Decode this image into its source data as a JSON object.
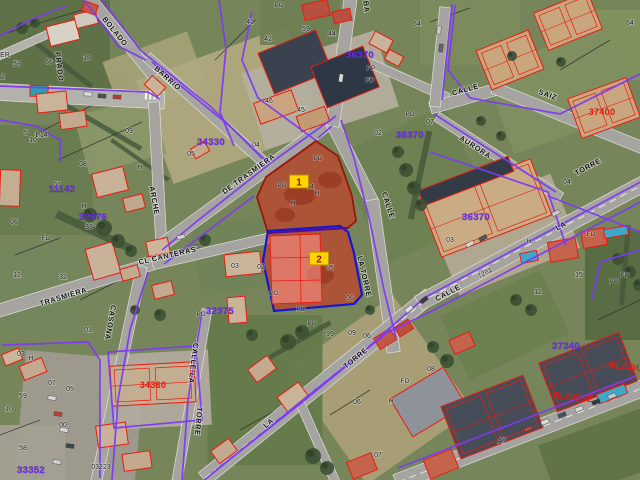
{
  "app": {
    "title": "Cadastral aerial map with highlighted parcels"
  },
  "map": {
    "type": "cadastral-aerial-map",
    "highlighted_parcels": [
      {
        "marker": "1",
        "parcel_number": "04",
        "x": 299,
        "y": 182
      },
      {
        "marker": "2",
        "parcel_number": "05",
        "x": 319,
        "y": 259
      }
    ],
    "colors": {
      "parcel_highlight_fill": "rgba(221,38,24,0.52)",
      "parcel1_border": "#9a1608",
      "parcel2_border": "#1717cf",
      "parcel_divider": "#4a0f9e",
      "parcel_building_fill": "rgba(255,145,135,0.6)",
      "marker_fill": "#ffd400",
      "marker_border": "#b89000",
      "marker_text": "#8f1410",
      "boundary_purple": "#7c3bf2",
      "building_outline_red": "#ea1c10",
      "zone_text_purple": "#6d2cf0",
      "building_text_red": "#e31b12",
      "street_text": "#161616",
      "number_text": "#1b1b1b",
      "road_fill": "#a5a4a0",
      "pool_blue": "#3fa8c8"
    },
    "street_labels": [
      {
        "text": "BOLADO",
        "x": 113,
        "y": 33,
        "rot": 51
      },
      {
        "text": "BARRIO",
        "x": 166,
        "y": 80,
        "rot": 42
      },
      {
        "text": "PRADO",
        "x": 57,
        "y": 67,
        "rot": 83
      },
      {
        "text": "DE TRASMIERA",
        "x": 250,
        "y": 176,
        "rot": -36
      },
      {
        "text": "ARCHE",
        "x": 152,
        "y": 201,
        "rot": 80
      },
      {
        "text": "CL CANTERAS",
        "x": 168,
        "y": 258,
        "rot": -13
      },
      {
        "text": "TRASMIERA",
        "x": 64,
        "y": 299,
        "rot": -17
      },
      {
        "text": "CASONA",
        "x": 108,
        "y": 322,
        "rot": 100
      },
      {
        "text": "CALLE",
        "x": 386,
        "y": 206,
        "rot": 72
      },
      {
        "text": "LA TORRE",
        "x": 362,
        "y": 277,
        "rot": 77
      },
      {
        "text": "CALLE",
        "x": 466,
        "y": 92,
        "rot": -16
      },
      {
        "text": "SAIZ",
        "x": 547,
        "y": 97,
        "rot": 20
      },
      {
        "text": "AURORA",
        "x": 474,
        "y": 149,
        "rot": 33
      },
      {
        "text": "TORRE",
        "x": 589,
        "y": 169,
        "rot": -28
      },
      {
        "text": "LA",
        "x": 562,
        "y": 228,
        "rot": -28
      },
      {
        "text": "CALLE",
        "x": 449,
        "y": 295,
        "rot": -28
      },
      {
        "text": "TORRE",
        "x": 357,
        "y": 360,
        "rot": -39
      },
      {
        "text": "LA",
        "x": 270,
        "y": 425,
        "rot": -39
      },
      {
        "text": "CALLE LA",
        "x": 191,
        "y": 363,
        "rot": 97
      },
      {
        "text": "TORRE",
        "x": 196,
        "y": 421,
        "rot": 95
      },
      {
        "text": "BA",
        "x": 364,
        "y": 7,
        "rot": 83
      }
    ],
    "zone_labels": [
      {
        "text": "36370",
        "x": 360,
        "y": 58
      },
      {
        "text": "36370",
        "x": 410,
        "y": 138
      },
      {
        "text": "36370",
        "x": 476,
        "y": 220
      },
      {
        "text": "11142",
        "x": 62,
        "y": 192
      },
      {
        "text": "32376",
        "x": 93,
        "y": 220
      },
      {
        "text": "32375",
        "x": 220,
        "y": 314
      },
      {
        "text": "34330",
        "x": 211,
        "y": 145
      },
      {
        "text": "33352",
        "x": 31,
        "y": 473
      },
      {
        "text": "37340",
        "x": 566,
        "y": 349
      }
    ],
    "building_labels": [
      {
        "text": "37400",
        "x": 602,
        "y": 115,
        "rot": 0
      },
      {
        "text": "34360",
        "x": 153,
        "y": 388,
        "rot": 0
      },
      {
        "text": "BLOQUE",
        "x": 573,
        "y": 400,
        "rot": 6
      },
      {
        "text": "BLOQUE",
        "x": 629,
        "y": 370,
        "rot": 6
      }
    ],
    "parcel_numbers": [
      {
        "text": "ER",
        "x": 5,
        "y": 57
      },
      {
        "text": "53",
        "x": 17,
        "y": 66
      },
      {
        "text": "66",
        "x": 49,
        "y": 64
      },
      {
        "text": "18",
        "x": 87,
        "y": 60
      },
      {
        "text": "2",
        "x": 3,
        "y": 79
      },
      {
        "text": "5",
        "x": 26,
        "y": 135
      },
      {
        "text": "1.14",
        "x": 41,
        "y": 137
      },
      {
        "text": "10",
        "x": 33,
        "y": 142
      },
      {
        "text": "09",
        "x": 129,
        "y": 133
      },
      {
        "text": "05",
        "x": 191,
        "y": 156
      },
      {
        "text": "41",
        "x": 250,
        "y": 24
      },
      {
        "text": "42",
        "x": 268,
        "y": 41
      },
      {
        "text": "59",
        "x": 306,
        "y": 31
      },
      {
        "text": "44",
        "x": 332,
        "y": 36
      },
      {
        "text": "64",
        "x": 417,
        "y": 26
      },
      {
        "text": "46",
        "x": 269,
        "y": 103
      },
      {
        "text": "45",
        "x": 301,
        "y": 112
      },
      {
        "text": "04",
        "x": 256,
        "y": 147
      },
      {
        "text": "02",
        "x": 378,
        "y": 135
      },
      {
        "text": "07",
        "x": 430,
        "y": 124
      },
      {
        "text": "64",
        "x": 630,
        "y": 25
      },
      {
        "text": "08",
        "x": 83,
        "y": 166
      },
      {
        "text": "07",
        "x": 57,
        "y": 187
      },
      {
        "text": "06",
        "x": 14,
        "y": 224
      },
      {
        "text": "33",
        "x": 89,
        "y": 229
      },
      {
        "text": "12",
        "x": 17,
        "y": 277
      },
      {
        "text": "32",
        "x": 63,
        "y": 279
      },
      {
        "text": "03",
        "x": 235,
        "y": 268
      },
      {
        "text": "02",
        "x": 261,
        "y": 269
      },
      {
        "text": "04",
        "x": 310,
        "y": 189
      },
      {
        "text": "05",
        "x": 330,
        "y": 270
      },
      {
        "text": "06",
        "x": 350,
        "y": 300
      },
      {
        "text": "04",
        "x": 567,
        "y": 184
      },
      {
        "text": "7201",
        "x": 486,
        "y": 275,
        "rot": -28
      },
      {
        "text": "12",
        "x": 538,
        "y": 294
      },
      {
        "text": "15",
        "x": 579,
        "y": 277
      },
      {
        "text": "03",
        "x": 450,
        "y": 242
      },
      {
        "text": "01",
        "x": 88,
        "y": 332
      },
      {
        "text": "03",
        "x": 21,
        "y": 356
      },
      {
        "text": "07",
        "x": 52,
        "y": 385
      },
      {
        "text": "05",
        "x": 70,
        "y": 391
      },
      {
        "text": "59",
        "x": 23,
        "y": 398
      },
      {
        "text": "10",
        "x": 9,
        "y": 411
      },
      {
        "text": "00",
        "x": 63,
        "y": 427
      },
      {
        "text": "58",
        "x": 23,
        "y": 450
      },
      {
        "text": "03223",
        "x": 101,
        "y": 469
      },
      {
        "text": "99",
        "x": 330,
        "y": 336
      },
      {
        "text": "09",
        "x": 352,
        "y": 335
      },
      {
        "text": "06",
        "x": 367,
        "y": 338
      },
      {
        "text": "06",
        "x": 357,
        "y": 404
      },
      {
        "text": "07",
        "x": 378,
        "y": 457
      },
      {
        "text": "08",
        "x": 431,
        "y": 371
      },
      {
        "text": "A7",
        "x": 502,
        "y": 443
      }
    ],
    "code_labels": [
      {
        "text": "PD",
        "x": 279,
        "y": 7
      },
      {
        "text": "PP",
        "x": 371,
        "y": 70
      },
      {
        "text": "FD",
        "x": 370,
        "y": 82
      },
      {
        "text": "PD",
        "x": 410,
        "y": 116
      },
      {
        "text": "H",
        "x": 140,
        "y": 169
      },
      {
        "text": "H",
        "x": 84,
        "y": 208
      },
      {
        "text": "FD",
        "x": 46,
        "y": 240
      },
      {
        "text": "PD",
        "x": 318,
        "y": 160
      },
      {
        "text": "PD",
        "x": 282,
        "y": 187
      },
      {
        "text": "H",
        "x": 317,
        "y": 195
      },
      {
        "text": "H",
        "x": 293,
        "y": 205
      },
      {
        "text": "PD",
        "x": 274,
        "y": 295
      },
      {
        "text": "PD",
        "x": 301,
        "y": 311
      },
      {
        "text": "PD",
        "x": 312,
        "y": 325
      },
      {
        "text": "FD",
        "x": 405,
        "y": 383
      },
      {
        "text": "H",
        "x": 391,
        "y": 403
      },
      {
        "text": "H",
        "x": 31,
        "y": 360
      },
      {
        "text": "FD",
        "x": 625,
        "y": 277
      },
      {
        "text": "PO",
        "x": 614,
        "y": 283
      },
      {
        "text": "PD",
        "x": 201,
        "y": 316
      },
      {
        "text": "H",
        "x": 529,
        "y": 243
      },
      {
        "text": "FD",
        "x": 591,
        "y": 236
      }
    ]
  }
}
